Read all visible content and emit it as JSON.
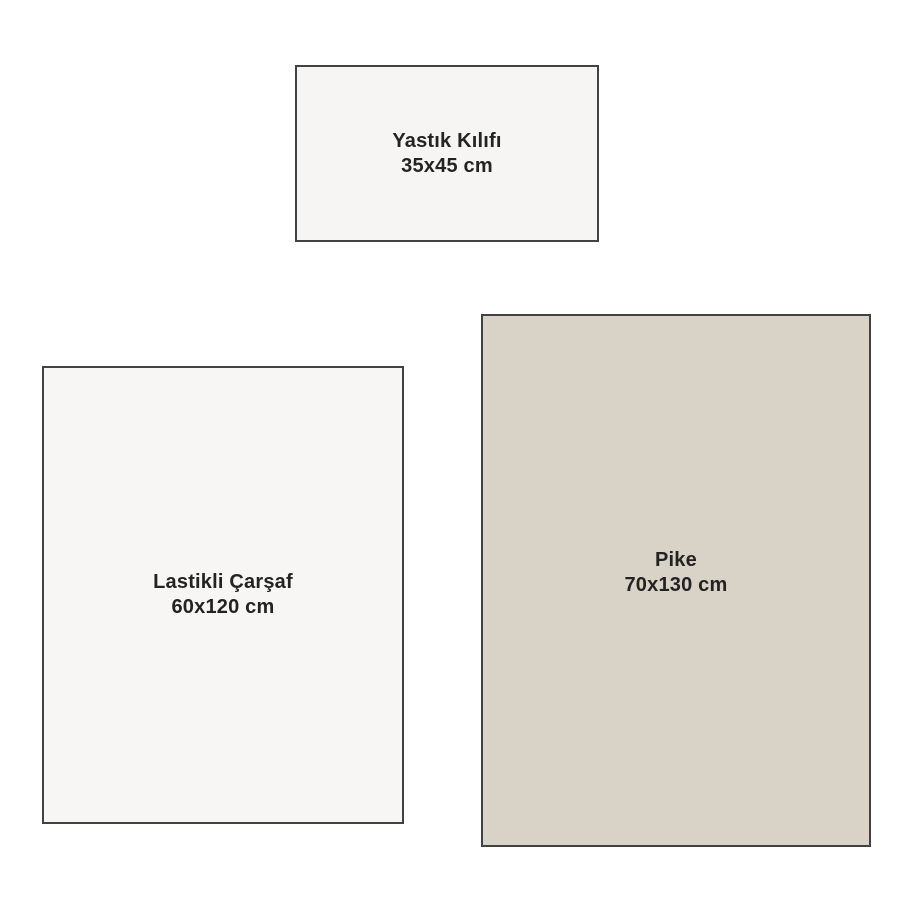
{
  "diagram": {
    "description": "Bedding set size diagram with three labeled rectangles",
    "items": [
      {
        "id": "yastik-kilifi",
        "name": "Yastık Kılıfı",
        "size": "35x45 cm",
        "fill": "#f6f5f4"
      },
      {
        "id": "lastikli-carsaf",
        "name": "Lastikli Çarşaf",
        "size": "60x120 cm",
        "fill": "#f7f6f5"
      },
      {
        "id": "pike",
        "name": "Pike",
        "size": "70x130 cm",
        "fill": "#d8d2c7"
      }
    ],
    "colors": {
      "background": "#ffffff",
      "border": "#424242",
      "text": "#232323"
    }
  }
}
